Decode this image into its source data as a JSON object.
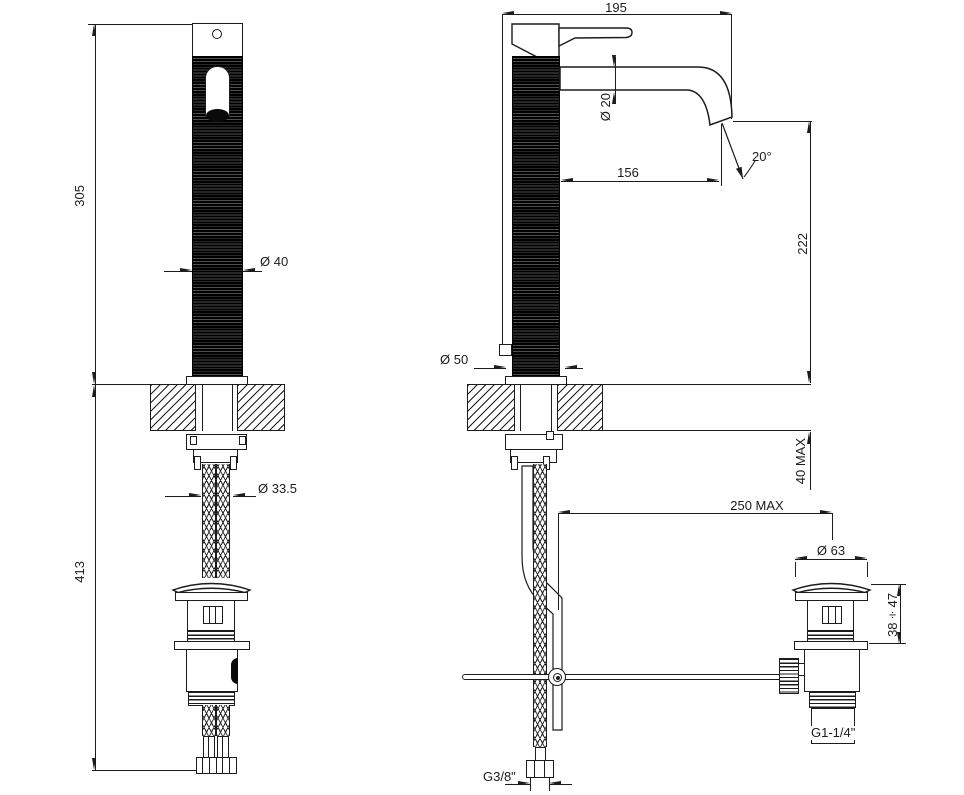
{
  "drawing": {
    "kind": "technical dimension drawing",
    "subject": "single-lever basin mixer tap with flexible supply hoses and pop-up waste",
    "line_color": "#1c1c1c",
    "background": "#ffffff"
  },
  "front_view": {
    "dims": {
      "height_above_deck": "305",
      "height_below_deck": "413",
      "body_diameter": "Ø 40",
      "mounting_hole_diameter": "Ø 33.5"
    }
  },
  "side_view": {
    "dims": {
      "overall_depth": "195",
      "spout_diameter": "Ø 20",
      "spout_reach": "156",
      "water_angle": "20°",
      "spout_height": "222",
      "base_diameter": "Ø 50",
      "counter_thickness": "40 MAX",
      "waste_offset": "250 MAX",
      "waste_cap_diameter": "Ø 63",
      "waste_height_range": "38÷47",
      "waste_thread": "G1-1/4\"",
      "supply_thread": "G3/8\""
    }
  }
}
